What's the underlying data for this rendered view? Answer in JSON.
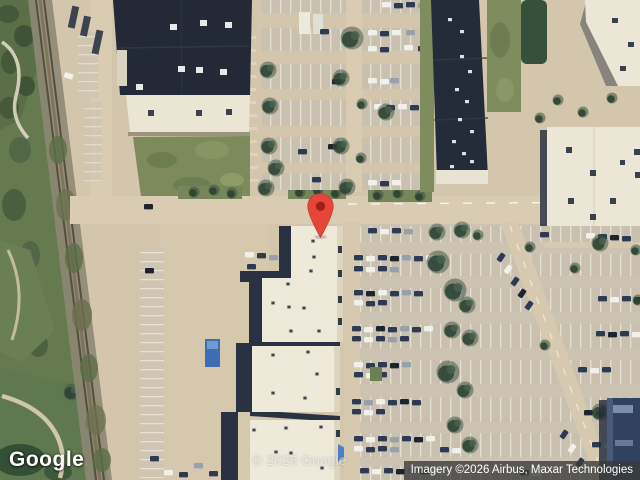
{
  "map": {
    "view_type": "satellite",
    "logo_text": "Google",
    "watermark_text": "© 2026 Google",
    "attribution_text": "Imagery ©2026 Airbus, Maxar Technologies",
    "marker": {
      "pixel_x": 320,
      "pixel_y": 238,
      "body_color": "#E8453A",
      "dot_color": "#9E1F17"
    },
    "palette": {
      "ground": "#d3c6ad",
      "road": "#d9ccb2",
      "vegetation": "#66794e",
      "dark_roof": "#232936",
      "light_roof": "#efe9da",
      "attribution_bg": "rgba(58,58,58,0.78)",
      "attribution_fg": "#ffffff"
    }
  }
}
